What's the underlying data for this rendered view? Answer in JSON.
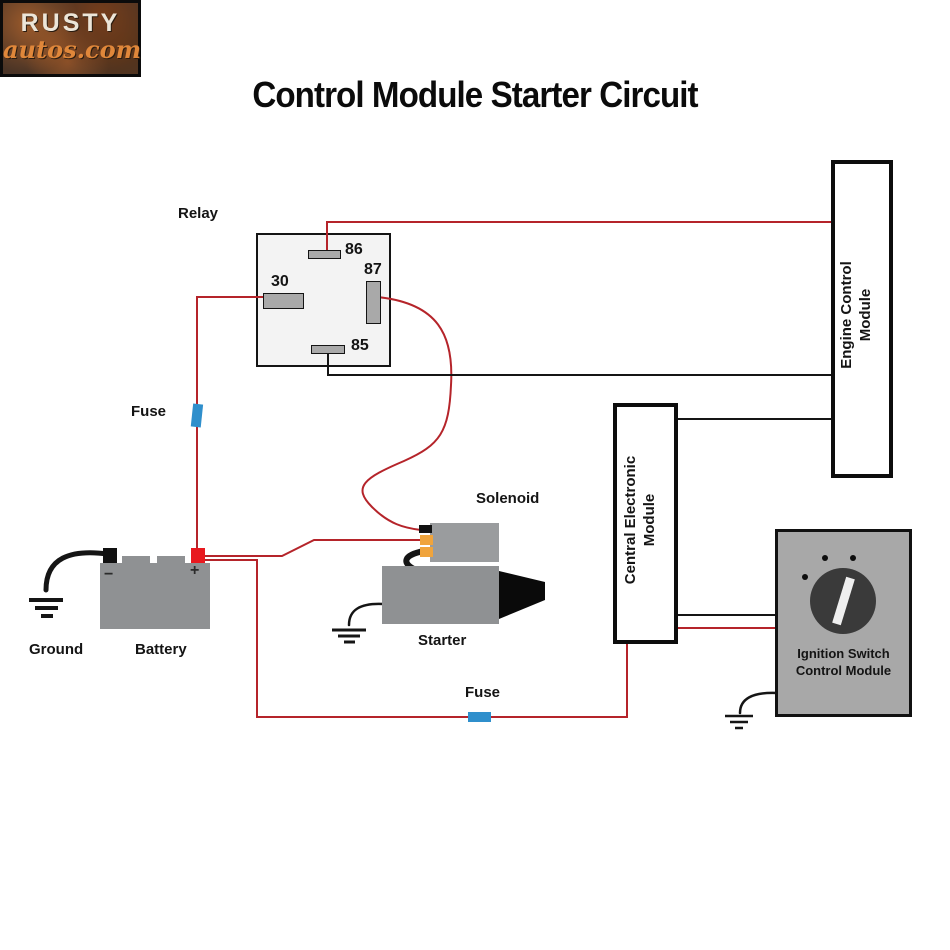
{
  "title": "Control Module Starter Circuit",
  "colors": {
    "wire-red": "#b5242a",
    "wire-black": "#151515",
    "fuse-blue": "#2f8fcc",
    "terminal-yellow": "#f0a43c",
    "terminal-red": "#e8191f",
    "component-gray": "#8f9193",
    "module-gray": "#a8a8a8",
    "relay-fill": "#f3f3f3",
    "knob-dark": "#3a3a3a",
    "logo-orange": "#e0873a",
    "logo-brown": "#4a3426"
  },
  "relay": {
    "pin86": "86",
    "pin87": "87",
    "pin30": "30",
    "pin85": "85"
  },
  "modules": {
    "engine": {
      "line1": "Engine Control",
      "line2": "Module"
    },
    "central": {
      "line1": "Central Electronic",
      "line2": "Module"
    },
    "ignition": {
      "line1": "Ignition Switch",
      "line2": "Control Module"
    }
  },
  "labels": {
    "relay": "Relay",
    "fuse_left": "Fuse",
    "ground": "Ground",
    "battery": "Battery",
    "solenoid": "Solenoid",
    "starter": "Starter",
    "fuse_bottom": "Fuse"
  },
  "battery": {
    "minus": "−",
    "plus": "+"
  },
  "logo": {
    "line1": "RUSTY",
    "line2": "autos.com"
  }
}
